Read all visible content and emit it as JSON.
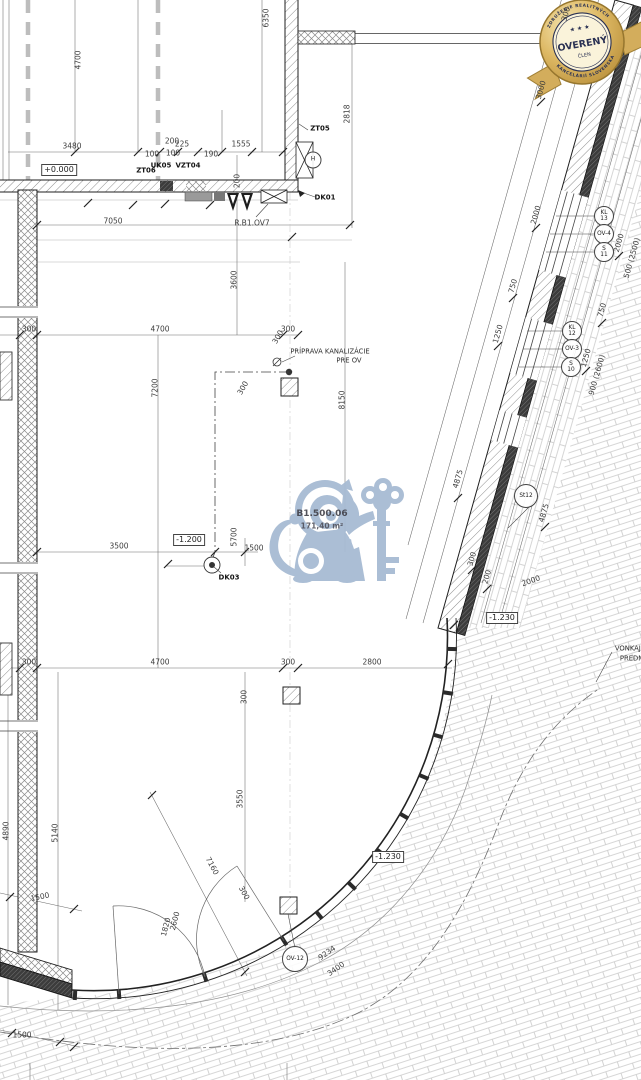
{
  "badge": {
    "title": "OVERENÝ",
    "subtitle": "ČLEN",
    "arc_top": "ZDRUŽENIE REALITNÝCH",
    "arc_bottom": "KANCELÁRIÍ SLOVENSKA",
    "stars": "★ ★ ★",
    "gold": "#d2ab58",
    "navy": "#2a3153"
  },
  "watermark": {
    "room_id": "B1.500.06",
    "room_area": "171,40 m²",
    "color": "#a7bbd3"
  },
  "colors": {
    "paper": "#ffffff",
    "wall_line": "#222222",
    "dimension_text": "#3d3d3d",
    "paving_line": "#c9c9c9",
    "grid_dash": "#bdbdbd"
  },
  "annotations": [
    {
      "t": "3480",
      "x": 72,
      "y": 146
    },
    {
      "t": "100",
      "x": 152,
      "y": 154
    },
    {
      "t": "200",
      "x": 172,
      "y": 141
    },
    {
      "t": "225",
      "x": 182,
      "y": 144
    },
    {
      "t": "100",
      "x": 173,
      "y": 153
    },
    {
      "t": "190",
      "x": 211,
      "y": 154
    },
    {
      "t": "1555",
      "x": 241,
      "y": 144
    },
    {
      "t": "4700",
      "x": 78,
      "y": 60,
      "r": -90
    },
    {
      "t": "6350",
      "x": 266,
      "y": 18,
      "r": -90
    },
    {
      "t": "2818",
      "x": 347,
      "y": 114,
      "r": -90
    },
    {
      "t": "7050",
      "x": 113,
      "y": 221
    },
    {
      "t": "200",
      "x": 237,
      "y": 181,
      "r": -90
    },
    {
      "t": "3600",
      "x": 234,
      "y": 280,
      "r": -90
    },
    {
      "t": "300",
      "x": 29,
      "y": 329
    },
    {
      "t": "4700",
      "x": 160,
      "y": 329
    },
    {
      "t": "300",
      "x": 288,
      "y": 329
    },
    {
      "t": "7200",
      "x": 155,
      "y": 388,
      "r": -90
    },
    {
      "t": "8150",
      "x": 342,
      "y": 400,
      "r": -90
    },
    {
      "t": "300",
      "x": 278,
      "y": 337,
      "r": -60
    },
    {
      "t": "300",
      "x": 243,
      "y": 388,
      "r": -60
    },
    {
      "t": "3500",
      "x": 119,
      "y": 546
    },
    {
      "t": "5700",
      "x": 234,
      "y": 537,
      "r": -90
    },
    {
      "t": "1500",
      "x": 254,
      "y": 548
    },
    {
      "t": "300",
      "x": 29,
      "y": 662
    },
    {
      "t": "4700",
      "x": 160,
      "y": 662
    },
    {
      "t": "300",
      "x": 288,
      "y": 662
    },
    {
      "t": "2800",
      "x": 372,
      "y": 662
    },
    {
      "t": "300",
      "x": 244,
      "y": 697,
      "r": -90
    },
    {
      "t": "3550",
      "x": 240,
      "y": 799,
      "r": -90
    },
    {
      "t": "5140",
      "x": 55,
      "y": 833,
      "r": -90
    },
    {
      "t": "4890",
      "x": 6,
      "y": 831,
      "r": -90
    },
    {
      "t": "1500",
      "x": 40,
      "y": 897,
      "r": -12
    },
    {
      "t": "7160",
      "x": 212,
      "y": 866,
      "r": 62
    },
    {
      "t": "300",
      "x": 244,
      "y": 893,
      "r": 62
    },
    {
      "t": "1820",
      "x": 166,
      "y": 927,
      "r": -75
    },
    {
      "t": "2600",
      "x": 175,
      "y": 921,
      "r": -75
    },
    {
      "t": "9234",
      "x": 327,
      "y": 953,
      "r": -35
    },
    {
      "t": "3400",
      "x": 336,
      "y": 969,
      "r": -35
    },
    {
      "t": "1500",
      "x": 22,
      "y": 1035
    },
    {
      "t": "3000",
      "x": 541,
      "y": 90,
      "r": -74
    },
    {
      "t": "300",
      "x": 566,
      "y": 14,
      "r": -74
    },
    {
      "t": "2000",
      "x": 536,
      "y": 215,
      "r": -74
    },
    {
      "t": "750",
      "x": 513,
      "y": 286,
      "r": -74
    },
    {
      "t": "1250",
      "x": 498,
      "y": 334,
      "r": -74
    },
    {
      "t": "4875",
      "x": 458,
      "y": 479,
      "r": -74
    },
    {
      "t": "4875",
      "x": 544,
      "y": 513,
      "r": -74
    },
    {
      "t": "300",
      "x": 472,
      "y": 559,
      "r": -74
    },
    {
      "t": "200",
      "x": 487,
      "y": 577,
      "r": -74
    },
    {
      "t": "2000",
      "x": 531,
      "y": 581,
      "r": -20
    },
    {
      "t": "2000",
      "x": 619,
      "y": 243,
      "r": -74
    },
    {
      "t": "500 (2500)",
      "x": 632,
      "y": 258,
      "r": -74
    },
    {
      "t": "750",
      "x": 602,
      "y": 310,
      "r": -74
    },
    {
      "t": "1250",
      "x": 586,
      "y": 358,
      "r": -74
    },
    {
      "t": "900 (2600)",
      "x": 597,
      "y": 375,
      "r": -74
    },
    {
      "t": "ZT05",
      "x": 320,
      "y": 129,
      "c": "lbl"
    },
    {
      "t": "ZT06",
      "x": 146,
      "y": 171,
      "c": "lbl"
    },
    {
      "t": "UK05",
      "x": 161,
      "y": 166,
      "c": "lbl"
    },
    {
      "t": "VZT04",
      "x": 188,
      "y": 166,
      "c": "lbl"
    },
    {
      "t": "DK01",
      "x": 325,
      "y": 198,
      "c": "lbl"
    },
    {
      "t": "DK03",
      "x": 229,
      "y": 578,
      "c": "lbl"
    },
    {
      "t": "R.B1.OV7",
      "x": 252,
      "y": 223
    },
    {
      "t": "+0.000",
      "x": 59,
      "y": 170,
      "c": "box"
    },
    {
      "t": "-1.200",
      "x": 189,
      "y": 540,
      "c": "box"
    },
    {
      "t": "-1.230",
      "x": 502,
      "y": 618,
      "c": "box"
    },
    {
      "t": "-1.230",
      "x": 388,
      "y": 857,
      "c": "box"
    },
    {
      "t": "PRÍPRAVA KANALIZÁCIE",
      "x": 330,
      "y": 352,
      "c": "note"
    },
    {
      "t": "PRE OV",
      "x": 349,
      "y": 361,
      "c": "note"
    },
    {
      "t": "VONKAJŠ",
      "x": 630,
      "y": 649,
      "c": "note"
    },
    {
      "t": "PREDM",
      "x": 632,
      "y": 659,
      "c": "note"
    }
  ],
  "ref_circles": [
    {
      "a": "KL",
      "b": "13",
      "x": 604,
      "y": 216
    },
    {
      "a": "OV-4",
      "x": 604,
      "y": 234
    },
    {
      "a": "S",
      "b": "11",
      "x": 604,
      "y": 252
    },
    {
      "a": "KL",
      "b": "12",
      "x": 572,
      "y": 331
    },
    {
      "a": "OV-3",
      "x": 572,
      "y": 349
    },
    {
      "a": "S",
      "b": "10",
      "x": 571,
      "y": 367
    },
    {
      "a": "St12",
      "x": 526,
      "y": 496,
      "d": 22
    },
    {
      "a": "OV-12",
      "x": 295,
      "y": 959,
      "d": 24
    },
    {
      "a": "H",
      "x": 313,
      "y": 160,
      "d": 15
    }
  ]
}
